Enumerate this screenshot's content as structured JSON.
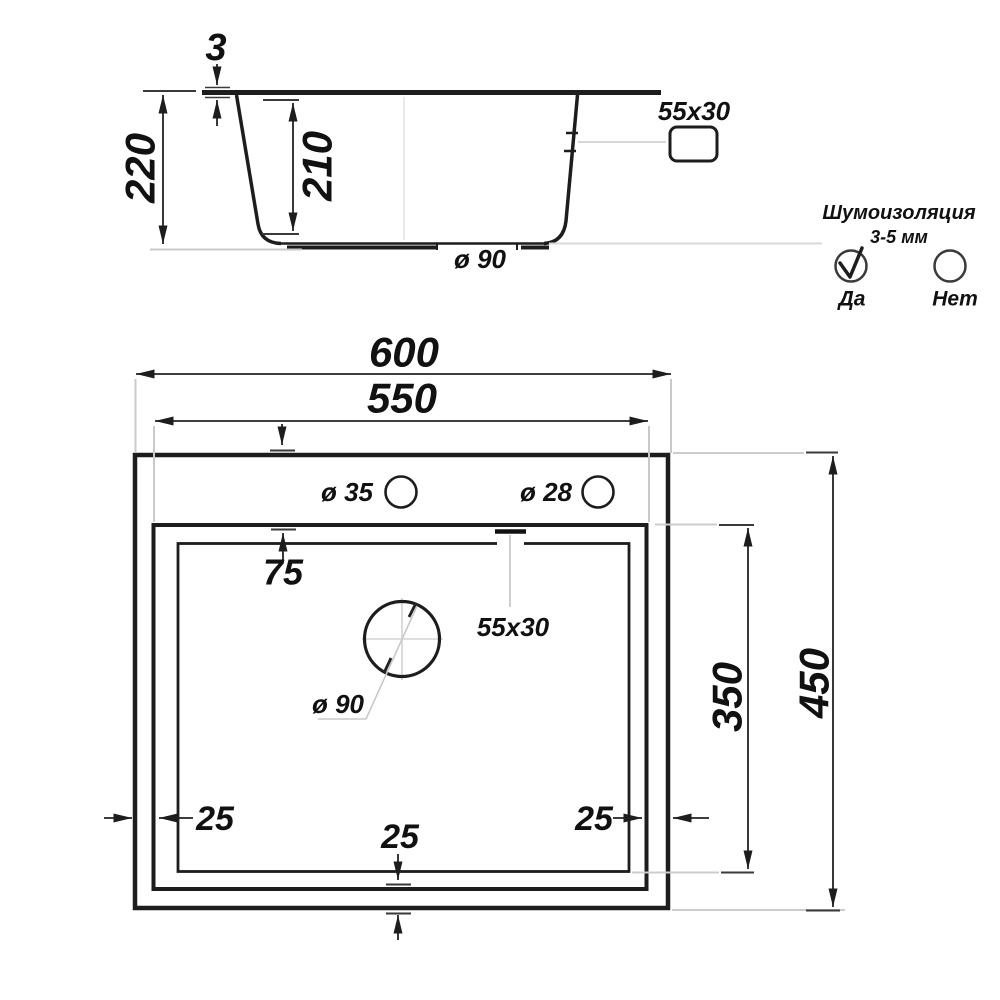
{
  "side_view": {
    "rim_thickness": "3",
    "overall_depth": "220",
    "bowl_depth": "210",
    "drain_diameter": "ø 90",
    "overflow_size": "55x30"
  },
  "insulation": {
    "title": "Шумоизоляция",
    "range": "3-5 мм",
    "yes": "Да",
    "no": "Нет"
  },
  "top_view": {
    "width_outer": "600",
    "width_bowl": "550",
    "offset_top": "75",
    "hole_faucet": "ø 35",
    "hole_dispenser": "ø 28",
    "overflow_size": "55x30",
    "drain_diameter": "ø 90",
    "margin_left": "25",
    "margin_bottom": "25",
    "margin_right": "25",
    "length_bowl": "350",
    "length_outer": "450"
  },
  "colors": {
    "line": "#1d1d1d",
    "dimension": "#222222",
    "extension": "#c9c9c9",
    "background": "#ffffff"
  }
}
